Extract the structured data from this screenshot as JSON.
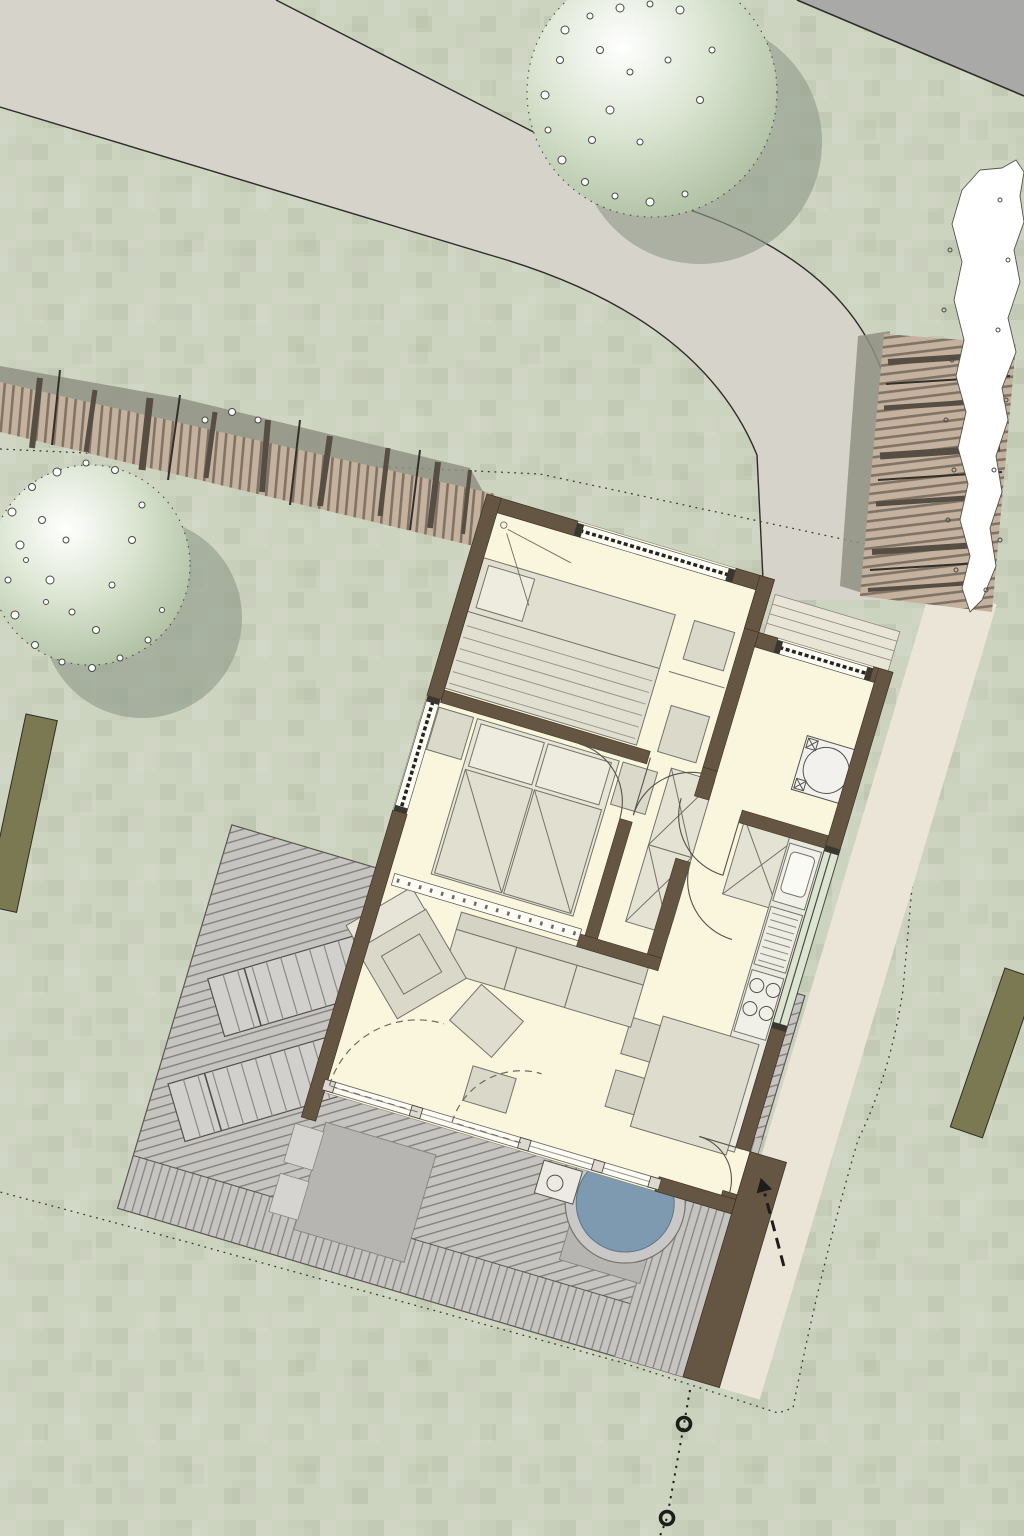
{
  "image_type": "architectural site plan (top-down rendering, no text labels)",
  "colors": {
    "grass": "#ccd3bf",
    "road_light": "#d6d3cb",
    "road_dark": "#a9a9a7",
    "outline": "#2e2d29",
    "boundary": "#3a3a33",
    "tree_light": "#ffffff",
    "tree_mid": "#dbe5d2",
    "tree_dark": "#a9bb9c",
    "tree_shadow": "#8e9a88",
    "fence_wood": "#c4b29f",
    "fence_plank": "#72685a",
    "fence_shadow": "#8f9183",
    "hedge_olive": "#7b7951",
    "path": "#eae5d7",
    "deck": "#c6c4c1",
    "deck_line": "#6e6a62",
    "deck_pad": "#b7b5b2",
    "water": "#7d9ab1",
    "wall": "#655643",
    "floor": "#f9f6dd",
    "furniture": "#e0dfd0",
    "furniture_light": "#edecde",
    "furniture_line": "#75736a",
    "glass_white": "#fdfdf6",
    "glazing": "#26241f",
    "window_green": "#dce5d2",
    "white": "#ffffff"
  },
  "site": {
    "roads": [
      "curved footpath/driveway",
      "street corner top-right"
    ],
    "trees": 2,
    "timber_fences": 2,
    "olive_hedges": 2,
    "white_shrub_row": 1,
    "property_boundary_style": "dotted",
    "survey_markers": 2
  },
  "house": {
    "rotation_deg": 16.6,
    "rooms": [
      "bedroom-1",
      "bedroom-2",
      "hall",
      "entry-utility",
      "kitchen",
      "living-dining"
    ],
    "fixtures": [
      "washing-machine",
      "wardrobes",
      "kitchen-counter",
      "sink",
      "stove",
      "beds",
      "sofa",
      "coffee-table",
      "armchair",
      "dining-table"
    ]
  },
  "outdoor": {
    "deck": "diagonal timber boards",
    "sun_loungers": 2,
    "hot_tub": 1,
    "entrance_arrow": "dashed with arrowhead",
    "entry_steps": 3
  }
}
